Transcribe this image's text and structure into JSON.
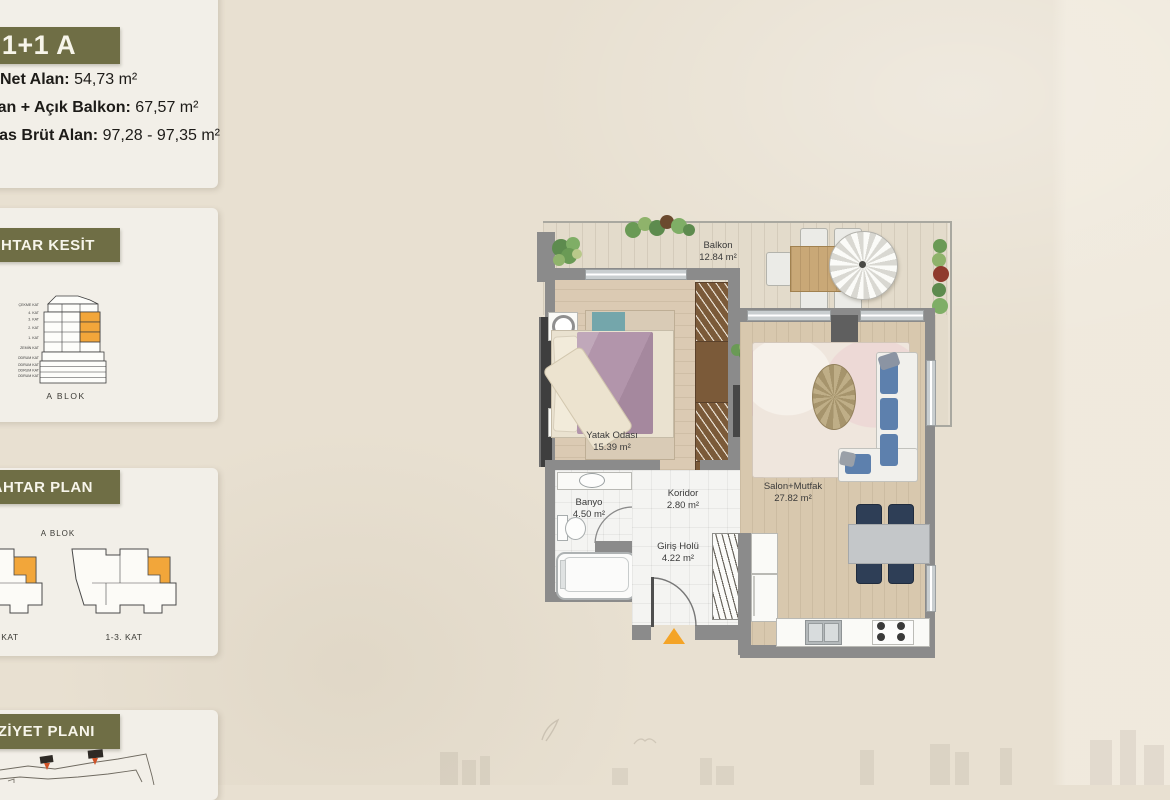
{
  "sidebar": {
    "unit_badge": "1+1 A",
    "areas": [
      {
        "label": "Net Alan:",
        "value": " 54,73 m²"
      },
      {
        "label": "Net Alan + Açık Balkon:",
        "value": " 67,57 m²"
      },
      {
        "label": "Satışa Esas Brüt Alan:",
        "value": " 97,28 - 97,35 m²"
      }
    ],
    "section_panel": {
      "title": "ANAHTAR KESİT",
      "block_label": "A BLOK",
      "floors": [
        "ÇEKME KAT",
        "4. KAT",
        "3. KAT",
        "2. KAT",
        "1. KAT",
        "ZEMİN KAT",
        "1. BODRUM KAT",
        "2. BODRUM KAT",
        "3. BODRUM KAT",
        "4. BODRUM KAT"
      ],
      "highlight_color": "#f2a63a"
    },
    "keyplan_panel": {
      "title": "ANAHTAR PLAN",
      "block_label": "A BLOK",
      "plans": [
        {
          "label": "ZEMİN KAT"
        },
        {
          "label": "1-3. KAT"
        }
      ]
    },
    "siteplan_panel": {
      "title": "VAZİYET PLANI"
    }
  },
  "floorplan": {
    "rooms": [
      {
        "name": "Balkon",
        "area": "12.84 m²"
      },
      {
        "name": "Yatak Odası",
        "area": "15.39 m²"
      },
      {
        "name": "Salon+Mutfak",
        "area": "27.82 m²"
      },
      {
        "name": "Banyo",
        "area": "4.50 m²"
      },
      {
        "name": "Koridor",
        "area": "2.80 m²"
      },
      {
        "name": "Giriş Holü",
        "area": "4.22 m²"
      }
    ],
    "entrance_marker_color": "#f4a427"
  },
  "colors": {
    "badge_olive": "#6f6e45",
    "highlight_orange": "#f2a63a",
    "page_beige": "#e8e0d1",
    "card": "#f2efe8",
    "wall_gray": "#8b8b8b"
  }
}
